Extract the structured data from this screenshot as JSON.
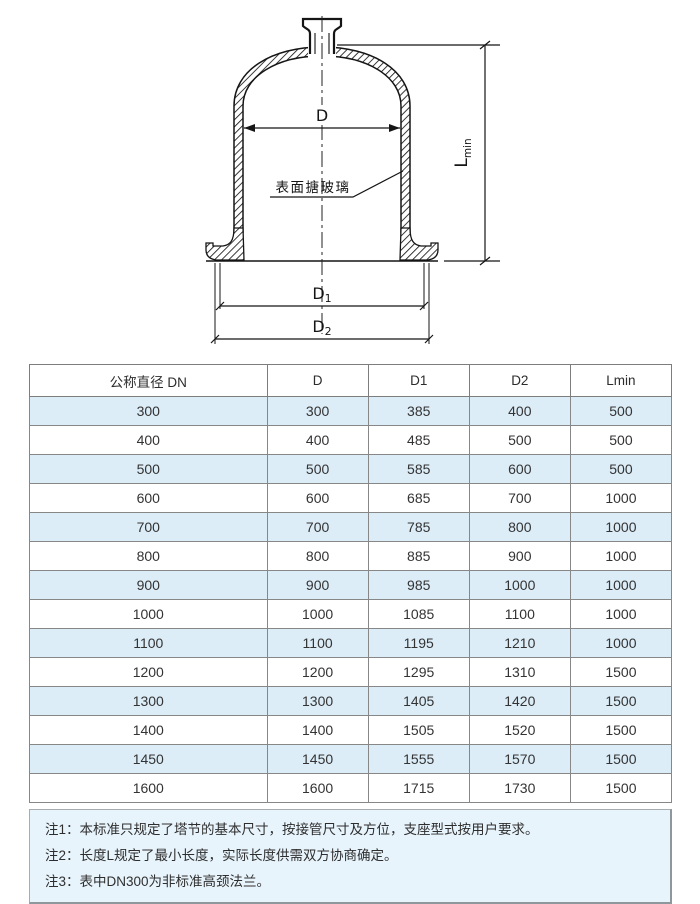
{
  "diagram": {
    "surface_label": "表面搪玻璃",
    "dim_d": "D",
    "dim_d1_main": "D",
    "dim_d1_sub": "1",
    "dim_d2_main": "D",
    "dim_d2_sub": "2",
    "dim_l_main": "L",
    "dim_l_sub": "min"
  },
  "table": {
    "headers": [
      "公称直径 DN",
      "D",
      "D1",
      "D2",
      "Lmin"
    ],
    "rows": [
      [
        300,
        300,
        385,
        400,
        500
      ],
      [
        400,
        400,
        485,
        500,
        500
      ],
      [
        500,
        500,
        585,
        600,
        500
      ],
      [
        600,
        600,
        685,
        700,
        1000
      ],
      [
        700,
        700,
        785,
        800,
        1000
      ],
      [
        800,
        800,
        885,
        900,
        1000
      ],
      [
        900,
        900,
        985,
        1000,
        1000
      ],
      [
        1000,
        1000,
        1085,
        1100,
        1000
      ],
      [
        1100,
        1100,
        1195,
        1210,
        1000
      ],
      [
        1200,
        1200,
        1295,
        1310,
        1500
      ],
      [
        1300,
        1300,
        1405,
        1420,
        1500
      ],
      [
        1400,
        1400,
        1505,
        1520,
        1500
      ],
      [
        1450,
        1450,
        1555,
        1570,
        1500
      ],
      [
        1600,
        1600,
        1715,
        1730,
        1500
      ]
    ]
  },
  "notes": [
    "注1：本标准只规定了塔节的基本尺寸，按接管尺寸及方位，支座型式按用户要求。",
    "注2：长度L规定了最小长度，实际长度供需双方协商确定。",
    "注3：表中DN300为非标准高颈法兰。"
  ],
  "colors": {
    "stripe": "#dcedf8",
    "panel": "#e8f4fc",
    "table-border": "#878787",
    "ink": "#151515"
  }
}
